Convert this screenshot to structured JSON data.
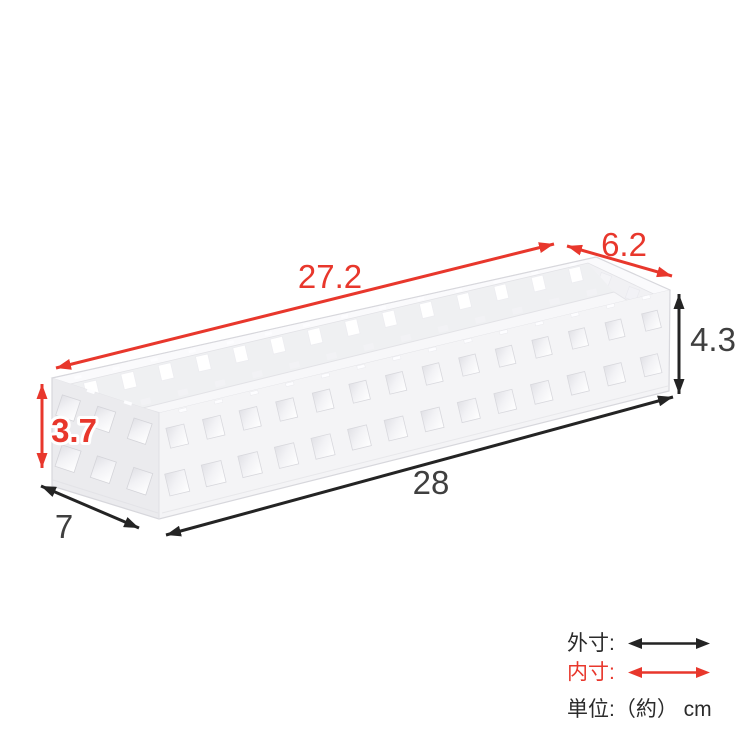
{
  "dims": {
    "inner_length": "27.2",
    "inner_width": "6.2",
    "outer_height": "4.3",
    "inner_height": "3.7",
    "outer_depth": "7",
    "outer_length": "28"
  },
  "legend": {
    "outer_label": "外寸:",
    "inner_label": "内寸:",
    "unit_label": "単位:（約） cm"
  },
  "colors": {
    "inner": "#e8372c",
    "outer": "#242424",
    "number": "#3f3f3f",
    "text": "#2b2b2b"
  }
}
